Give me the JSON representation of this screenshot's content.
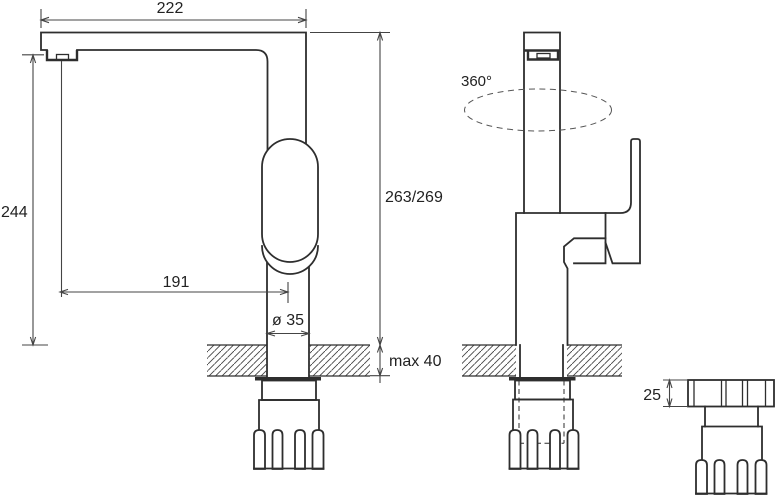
{
  "page": {
    "background": "#ffffff",
    "line_color": "#2e2e2e",
    "dimension_color": "#444444"
  },
  "drawing": {
    "kind": "kitchen faucet installation technical drawing",
    "views": [
      "side view",
      "front view",
      "mounting nut detail"
    ],
    "labels": {
      "spout_length": "222",
      "outlet_height": "244",
      "spout_reach_axis": "191",
      "base_diameter": "ø 35",
      "body_height": "263/269",
      "max_deck_thickness": "max 40",
      "swivel_angle": "360°",
      "nut_height": "25"
    }
  }
}
